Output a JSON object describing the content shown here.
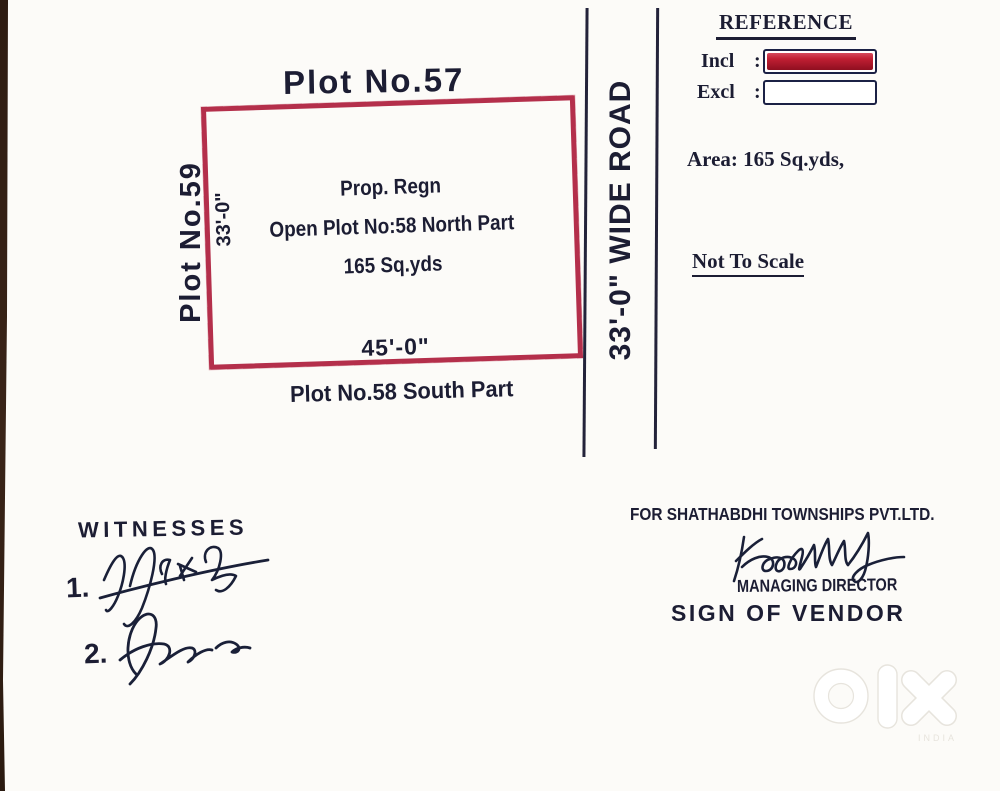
{
  "plot": {
    "top_label": "Plot No.57",
    "left_label": "Plot No.59",
    "inner_line1": "Prop. Regn",
    "inner_line2": "Open Plot No:58 North Part",
    "inner_line3": "165 Sq.yds",
    "width_dim": "45'-0\"",
    "height_dim": "33'-0\"",
    "bottom_label": "Plot No.58 South Part",
    "border_color": "#b42f4b"
  },
  "road": {
    "label": "33'-0\" WIDE ROAD"
  },
  "reference": {
    "title": "REFERENCE",
    "incl_label": "Incl",
    "excl_label": "Excl",
    "colon": ":",
    "incl_fill_color": "#c01f33",
    "area_text": "Area: 165 Sq.yds,",
    "scale_note": "Not To Scale"
  },
  "witnesses": {
    "title": "WITNESSES",
    "item1_number": "1.",
    "item2_number": "2."
  },
  "vendor": {
    "company_line": "FOR SHATHABDHI TOWNSHIPS PVT.LTD.",
    "role": "MANAGING DIRECTOR",
    "sign_label": "SIGN OF VENDOR"
  },
  "watermark": {
    "brand": "olx",
    "country": "INDIA"
  }
}
